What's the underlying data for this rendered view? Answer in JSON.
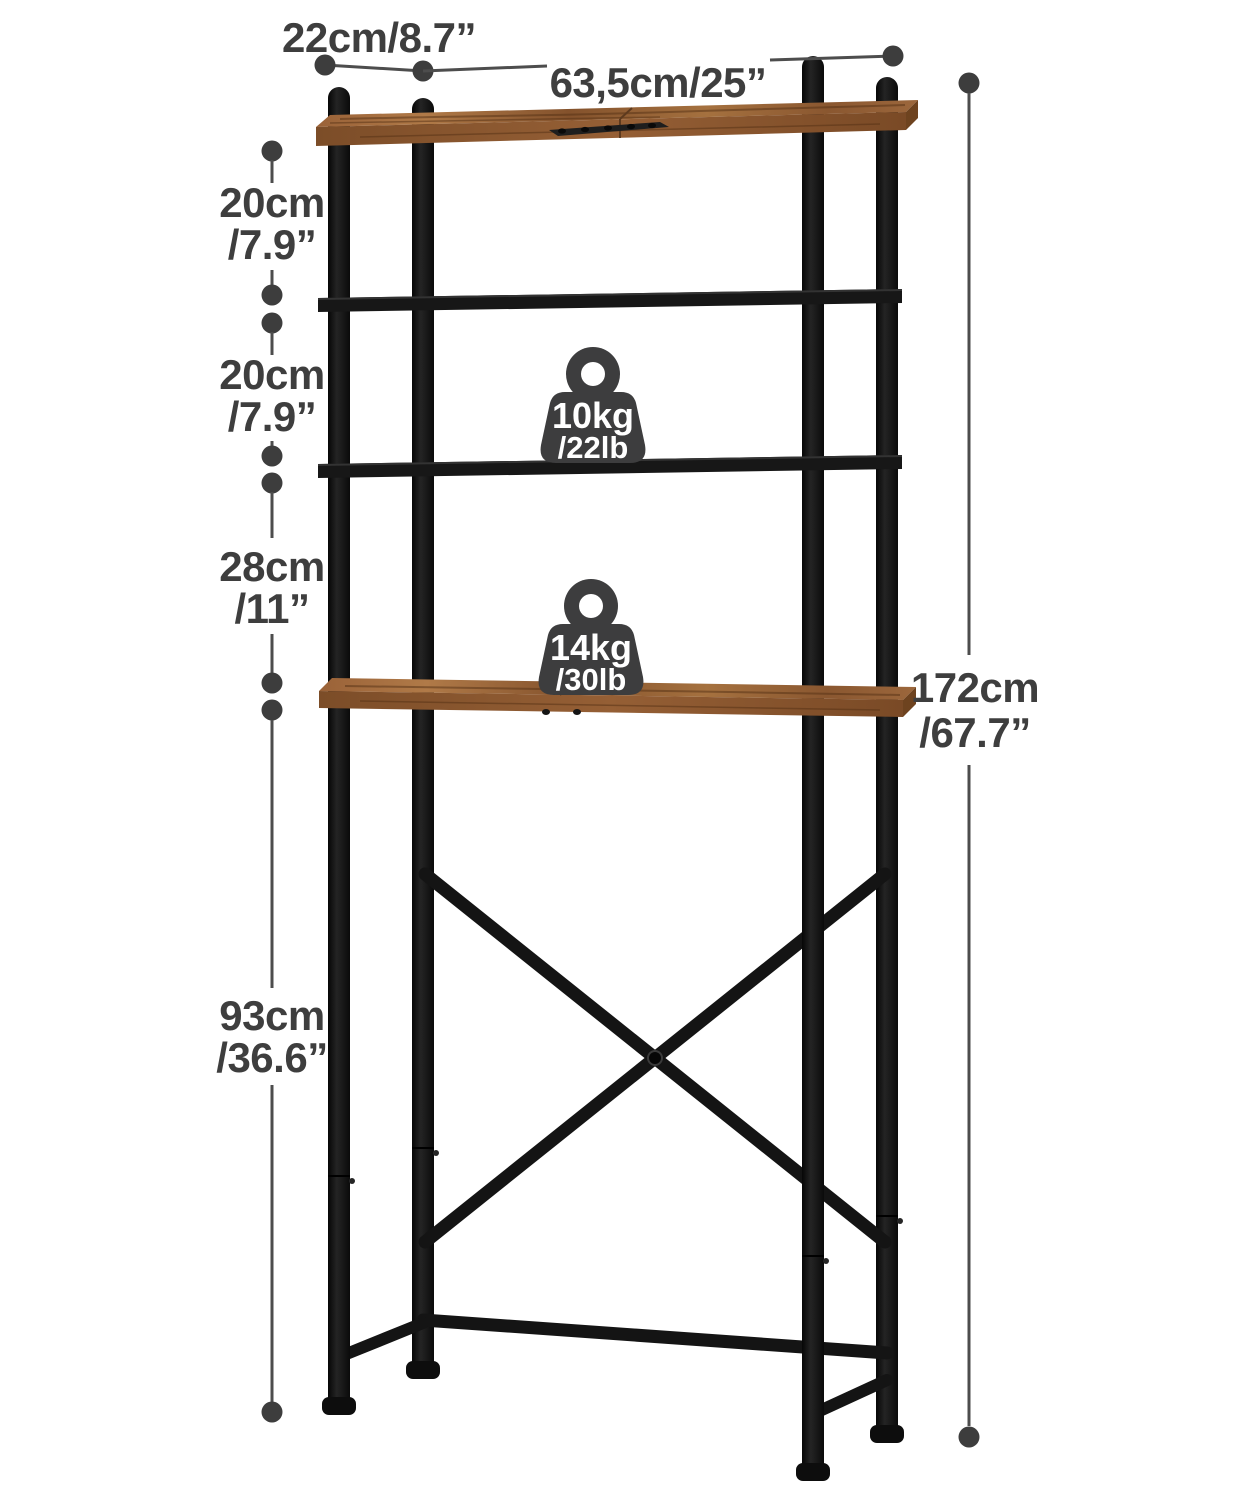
{
  "dimensions": {
    "depth": "22cm/8.7”",
    "width": "63,5cm/25”",
    "gaps": [
      {
        "cm": "20cm",
        "inch": "/7.9”"
      },
      {
        "cm": "20cm",
        "inch": "/7.9”"
      },
      {
        "cm": "28cm",
        "inch": "/11”"
      },
      {
        "cm": "93cm",
        "inch": "/36.6”"
      }
    ],
    "height": {
      "cm": "172cm",
      "inch": "/67.7”"
    }
  },
  "capacity_badges": [
    {
      "kg": "10kg",
      "lb": "/22lb"
    },
    {
      "kg": "14kg",
      "lb": "/30lb"
    }
  ],
  "colors": {
    "background": "#ffffff",
    "dimension_text": "#3e3e3e",
    "dimension_line": "#4d4d4d",
    "metal_frame": "#141414",
    "wood": "#8b5a33",
    "badge": "#3d3d3e",
    "badge_text": "#ffffff"
  }
}
